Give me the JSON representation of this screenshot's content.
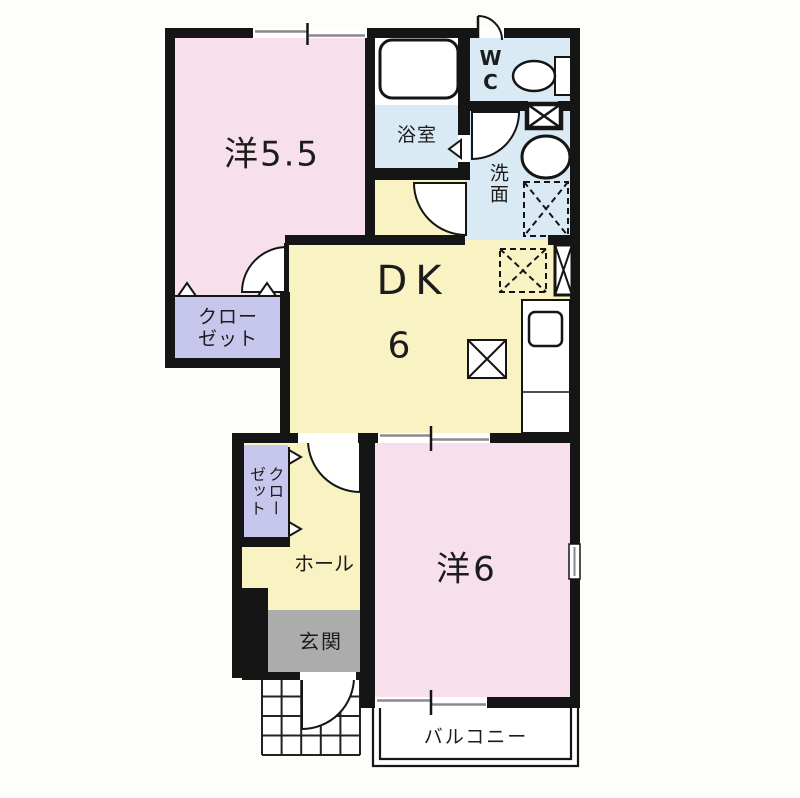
{
  "floorplan": {
    "title": "1DK apartment floor plan",
    "rooms": {
      "western55": {
        "label": "洋5.5"
      },
      "bath": {
        "label": "浴室"
      },
      "wc": {
        "label": "WC"
      },
      "washroom": {
        "label": "洗面"
      },
      "dk": {
        "label": "DK",
        "size": "6"
      },
      "closet_upper": {
        "label": "クローゼット"
      },
      "closet_lower": {
        "label": "クローゼット"
      },
      "hall": {
        "label": "ホール"
      },
      "entrance": {
        "label": "玄関"
      },
      "western6": {
        "label": "洋6"
      },
      "balcony": {
        "label": "バルコニー"
      }
    },
    "icons": [
      "bathtub-icon",
      "toilet-icon",
      "washbasin-icon",
      "kitchen-counter-sink-icon",
      "washer-space-icon",
      "refrigerator-space-icon",
      "pipe-space-icon",
      "meter-box-icon",
      "door-swing-icon",
      "folding-door-icon",
      "sliding-window-icon",
      "entrance-tile-grid"
    ],
    "colors": {
      "wall": "#151515",
      "room-pink": "#f7e0eb",
      "room-yellow": "#f9f3c4",
      "room-blue": "#d9eaf5",
      "closet-purple": "#c7c7ed",
      "entry-gray": "#acacac",
      "bg": "#fdfdfa",
      "window-gray": "#8a8a8a"
    }
  }
}
